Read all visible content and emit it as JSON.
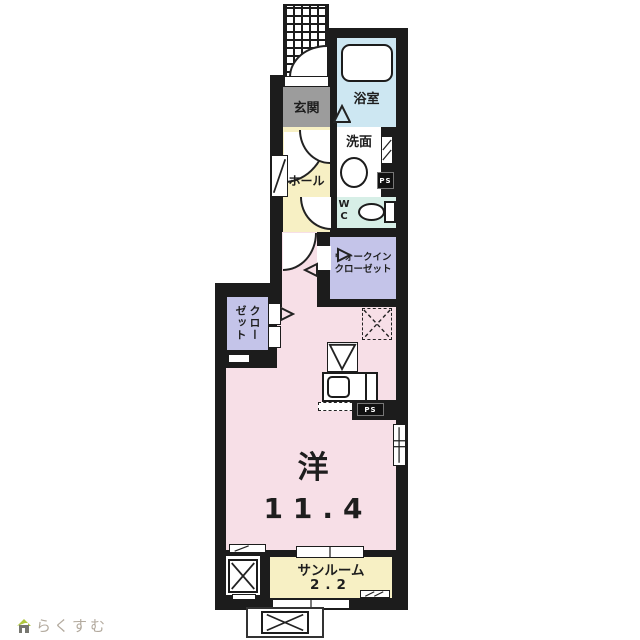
{
  "plan": {
    "rooms": {
      "genkan": {
        "label": "玄関"
      },
      "bath": {
        "label": "浴室"
      },
      "washroom": {
        "label": "洗面"
      },
      "hall": {
        "label": "ホール"
      },
      "wc": {
        "label": "W\nC"
      },
      "wic": {
        "line1": "ウォークイン",
        "line2": "クローゼット"
      },
      "closet": {
        "label": "クローゼット"
      },
      "main": {
        "label": "洋",
        "size": "11.4"
      },
      "sunroom": {
        "label": "サンルーム",
        "size": "2.2"
      }
    },
    "labels": {
      "ps": "PS"
    },
    "colors": {
      "wall": "#1c1c1c",
      "bath": "#cde7f2",
      "wc": "#d7efe7",
      "hall": "#f7f0c4",
      "sunroom": "#f7f0c4",
      "genkan": "#9c9c9c",
      "closet": "#c4c4e9",
      "main_room": "#f7dfe7"
    }
  },
  "footer": {
    "logo_text": "らくすむ"
  }
}
